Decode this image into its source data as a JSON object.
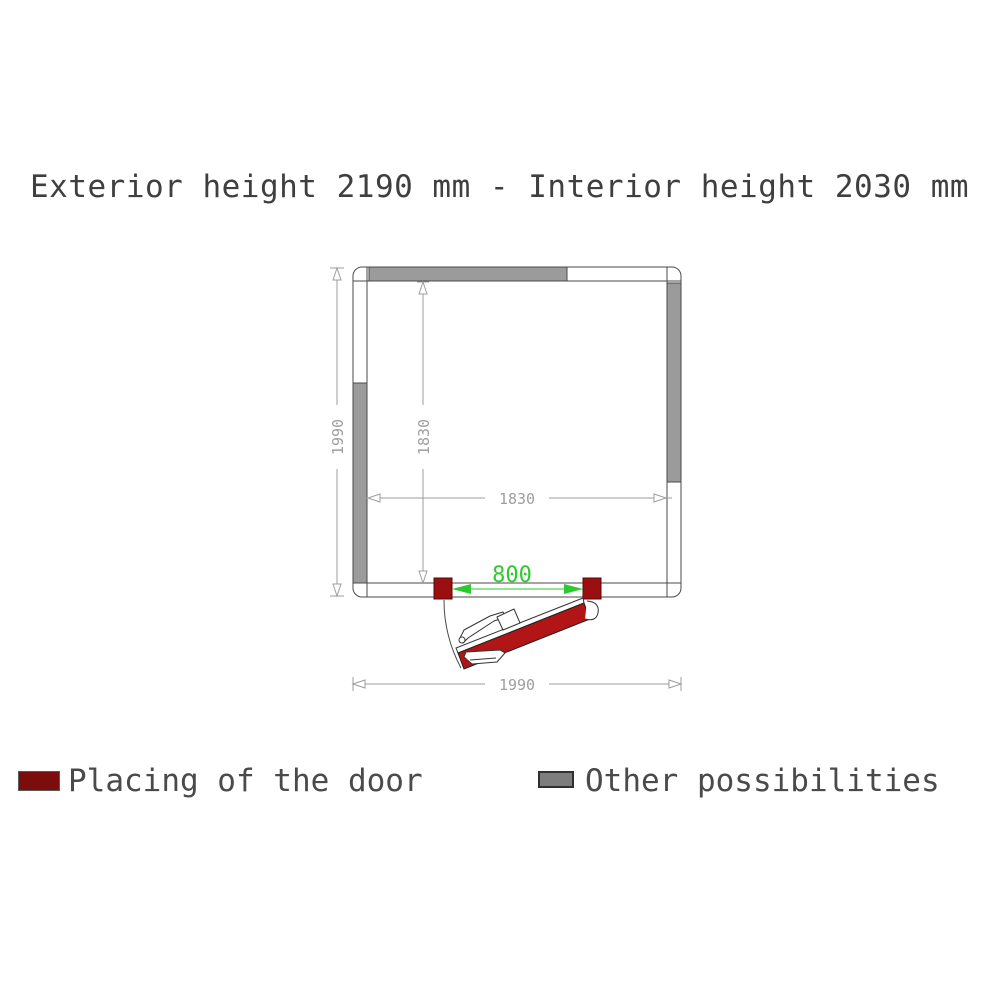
{
  "title": "Exterior height 2190 mm - Interior height 2030 mm",
  "plan": {
    "dims": {
      "exterior_vertical": "1990",
      "exterior_horizontal": "1990",
      "interior_vertical": "1830",
      "interior_horizontal": "1830",
      "door_opening": "800"
    }
  },
  "legend": {
    "door": {
      "label": "Placing of the door",
      "color": "#7c0d0d"
    },
    "other": {
      "label": "Other possibilities",
      "color": "#7d7d7d"
    }
  },
  "colors": {
    "door_leaf": "#b11515",
    "door_jamb": "#9a1010",
    "other_possibility": "#9b9b9b",
    "dimension_gray": "#9e9e9e",
    "door_opening_green": "#2fc92f",
    "outline": "#4a4a4a"
  }
}
